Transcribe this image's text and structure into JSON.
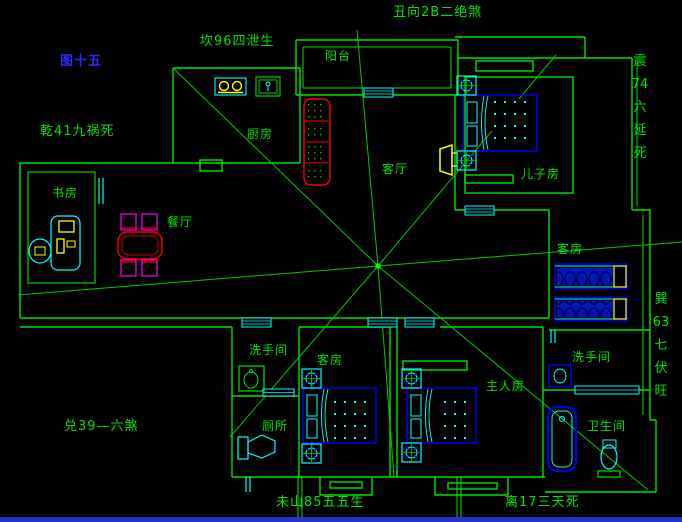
{
  "figure": {
    "caption": "图十五"
  },
  "annotations": {
    "north_top": "丑向2B二绝煞",
    "north_west_top": "坎96四泄生",
    "north_west": "乾41九祸死",
    "east_vertical": "震\n74\n六\n延\n死",
    "south_east_vertical": "巽\n63\n七\n伏\n旺",
    "west": "兑39—六煞",
    "south_center": "未山85五五生",
    "south_right": "离17三天死"
  },
  "rooms": {
    "balcony": "阳台",
    "kitchen": "厨房",
    "study": "书房",
    "dining": "餐厅",
    "living": "客厅",
    "son_bedroom": "儿子房",
    "guest_room_east": "客房",
    "guest_room_south": "客房",
    "washroom_west": "洗手间",
    "toilet": "厕所",
    "master_bedroom": "主人房",
    "washroom_east": "洗手间",
    "bathroom": "卫生间"
  },
  "colors": {
    "background": "#000000",
    "wall_green": "#00e400",
    "caption_blue": "#2b2bff",
    "fixture_cyan": "#00ffff",
    "bed_blue": "#0000ee",
    "sofa_red": "#ff0000",
    "chair_magenta": "#ff00ff",
    "appliance_yellow": "#ffff00",
    "bottom_strip_blue": "#2233cc"
  }
}
